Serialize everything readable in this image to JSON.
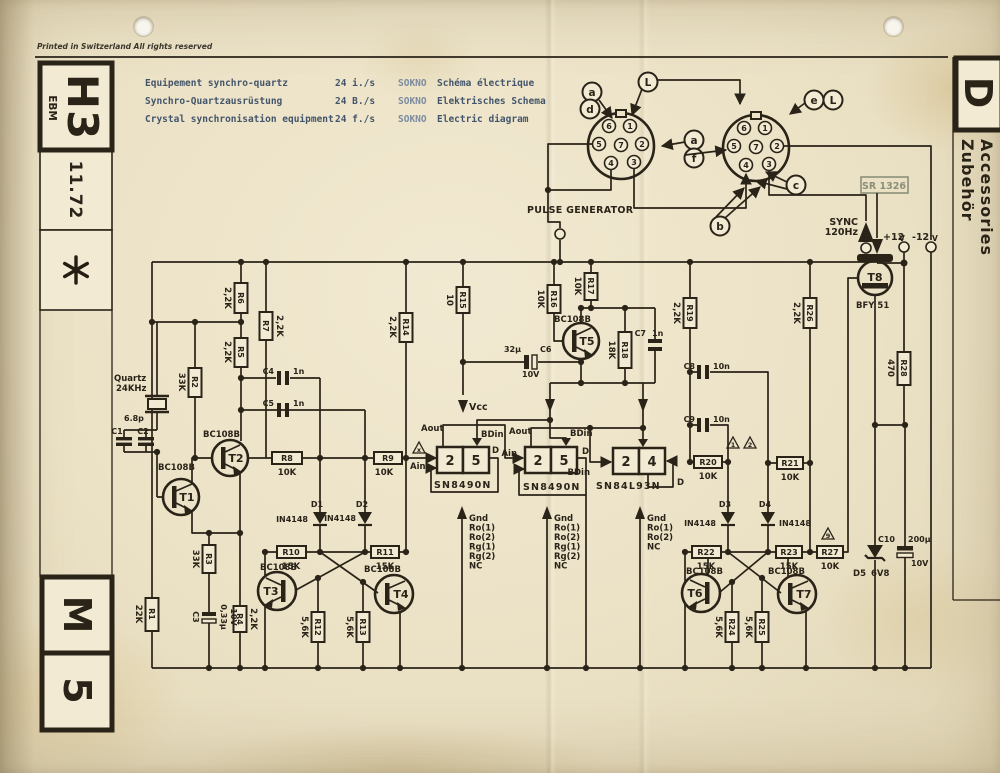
{
  "header": {
    "printed_note": "Printed in Switzerland  All rights reserved",
    "title_rows": [
      {
        "name": "Equipement synchro-quartz",
        "rate": "24 i./s",
        "code": "SOKNO",
        "doc": "Schéma électrique"
      },
      {
        "name": "Synchro-Quartzausrüstung",
        "rate": "24 B./s",
        "code": "SOKNO",
        "doc": "Elektrisches Schema"
      },
      {
        "name": "Crystal synchronisation equipment",
        "rate": "24 f./s",
        "code": "SOKNO",
        "doc": "Electric diagram"
      }
    ]
  },
  "margin_left": {
    "code": "H3",
    "brand": "EBM",
    "date": "11.72",
    "star": "✳",
    "m": "M",
    "five": "5"
  },
  "margin_right": {
    "letter": "D",
    "label_de": "Zubehör",
    "label_en": "Accessories"
  },
  "stamp": "SR 1326",
  "connector_labels": {
    "l": "L",
    "a": "a",
    "d": "d",
    "e": "e",
    "f": "f",
    "c": "c",
    "b": "b"
  },
  "pins": {
    "p1": "1",
    "p2": "2",
    "p3": "3",
    "p4": "4",
    "p5": "5",
    "p6": "6",
    "p7": "7"
  },
  "signals": {
    "pulse": "PULSE GENERATOR",
    "sync": "SYNC",
    "sync_freq": "120Hz",
    "plus12": "+12",
    "minus12": "-12",
    "volt": "V",
    "vcc": "Vcc",
    "aout": "Aout",
    "ain": "Ain",
    "bdin": "BDin",
    "d": "D"
  },
  "ic": {
    "ic1": {
      "name": "SN8490N",
      "left": "2",
      "right": "5"
    },
    "ic2": {
      "name": "SN8490N",
      "left": "2",
      "right": "5"
    },
    "ic3": {
      "name": "SN84L93N",
      "left": "2",
      "right": "4"
    }
  },
  "pinlist_long": [
    "Gnd",
    "Ro(1)",
    "Ro(2)",
    "Rg(1)",
    "Rg(2)",
    "NC"
  ],
  "pinlist_short": [
    "Gnd",
    "Ro(1)",
    "Ro(2)",
    "NC"
  ],
  "notes": {
    "x": "x",
    "n1": "1",
    "n2": "2",
    "n9": "9"
  },
  "quartz": {
    "name": "Quartz",
    "freq": "24KHz",
    "trim": "6.8p"
  },
  "resistors": {
    "R1": {
      "r": "R1",
      "v": "22K"
    },
    "R2": {
      "r": "R2",
      "v": "33K"
    },
    "R3": {
      "r": "R3",
      "v": "33K"
    },
    "R4": {
      "r": "R4",
      "v": "2,2K"
    },
    "R5": {
      "r": "R5",
      "v": "2,2K"
    },
    "R6": {
      "r": "R6",
      "v": "2,2K"
    },
    "R7": {
      "r": "R7",
      "v": "2,2K"
    },
    "R8": {
      "r": "R8",
      "v": "10K"
    },
    "R9": {
      "r": "R9",
      "v": "10K"
    },
    "R10": {
      "r": "R10",
      "v": "15K"
    },
    "R11": {
      "r": "R11",
      "v": "15K"
    },
    "R12": {
      "r": "R12",
      "v": "5,6K"
    },
    "R13": {
      "r": "R13",
      "v": "5,6K"
    },
    "R14": {
      "r": "R14",
      "v": "2,2K"
    },
    "R15": {
      "r": "R15",
      "v": "10"
    },
    "R16": {
      "r": "R16",
      "v": "10K"
    },
    "R17": {
      "r": "R17",
      "v": "10K"
    },
    "R18": {
      "r": "R18",
      "v": "18K"
    },
    "R19": {
      "r": "R19",
      "v": "2,2K"
    },
    "R20": {
      "r": "R20",
      "v": "10K"
    },
    "R21": {
      "r": "R21",
      "v": "10K"
    },
    "R22": {
      "r": "R22",
      "v": "15K"
    },
    "R23": {
      "r": "R23",
      "v": "15K"
    },
    "R24": {
      "r": "R24",
      "v": "5,6K"
    },
    "R25": {
      "r": "R25",
      "v": "5,6K"
    },
    "R26": {
      "r": "R26",
      "v": "2,2K"
    },
    "R27": {
      "r": "R27",
      "v": "10K"
    },
    "R28": {
      "r": "R28",
      "v": "470"
    }
  },
  "capacitors": {
    "C1": {
      "r": "C1"
    },
    "C2": {
      "r": "C2"
    },
    "C3": {
      "r": "C3",
      "v": "0,33μ",
      "volt": "10V"
    },
    "C4": {
      "r": "C4",
      "v": "1n"
    },
    "C5": {
      "r": "C5",
      "v": "1n"
    },
    "C6": {
      "r": "C6",
      "v": "32μ",
      "volt": "10V"
    },
    "C7": {
      "r": "C7",
      "v": "1n"
    },
    "C8": {
      "r": "C8",
      "v": "10n"
    },
    "C9": {
      "r": "C9",
      "v": "10n"
    },
    "C10": {
      "r": "C10",
      "v": "200μ",
      "volt": "10V"
    }
  },
  "diodes": {
    "D1": {
      "r": "D1",
      "v": "IN4148"
    },
    "D2": {
      "r": "D2",
      "v": "IN4148"
    },
    "D3": {
      "r": "D3",
      "v": "IN4148"
    },
    "D4": {
      "r": "D4",
      "v": "IN4148"
    },
    "D5": {
      "r": "D5",
      "v": "6V8"
    }
  },
  "transistors": {
    "T1": {
      "r": "T1",
      "t": "BC108B"
    },
    "T2": {
      "r": "T2",
      "t": "BC108B"
    },
    "T3": {
      "r": "T3",
      "t": "BC108B"
    },
    "T4": {
      "r": "T4",
      "t": "BC108B"
    },
    "T5": {
      "r": "T5",
      "t": "BC108B"
    },
    "T6": {
      "r": "T6",
      "t": "BC108B"
    },
    "T7": {
      "r": "T7",
      "t": "BC108B"
    },
    "T8": {
      "r": "T8",
      "t": "BFY 51"
    }
  }
}
